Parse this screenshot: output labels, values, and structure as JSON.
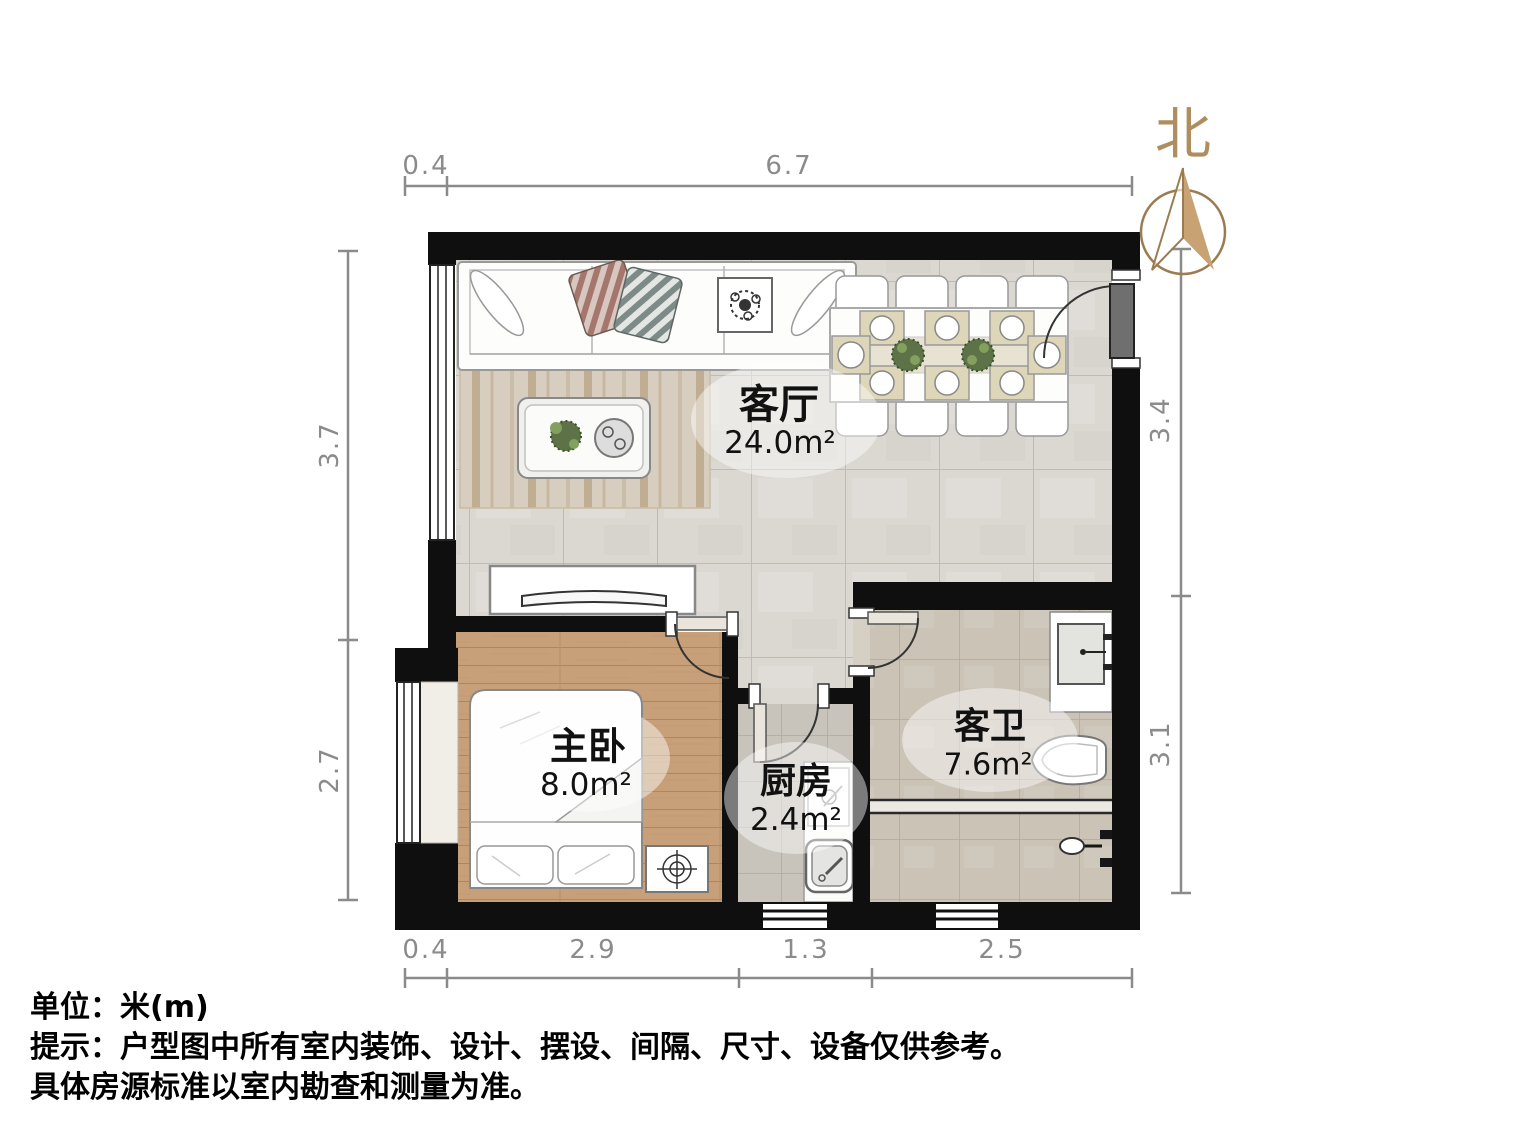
{
  "north": {
    "label": "北"
  },
  "rooms": {
    "living": {
      "name": "客厅",
      "area": "24.0m²"
    },
    "bedroom": {
      "name": "主卧",
      "area": "8.0m²"
    },
    "kitchen": {
      "name": "厨房",
      "area": "2.4m²"
    },
    "bathroom": {
      "name": "客卫",
      "area": "7.6m²"
    }
  },
  "dimensions": {
    "top": [
      "0.4",
      "6.7"
    ],
    "bottom": [
      "0.4",
      "2.9",
      "1.3",
      "2.5"
    ],
    "left": [
      "3.7",
      "2.7"
    ],
    "right": [
      "3.4",
      "3.1"
    ]
  },
  "footer": {
    "unit_line": "单位：米(m)",
    "note_line1": "提示：户型图中所有室内装饰、设计、摆设、间隔、尺寸、设备仅供参考。",
    "note_line2": "具体房源标准以室内勘查和测量为准。"
  },
  "icons": {
    "north_compass": "north-compass-arrow",
    "decor_plant": "flower"
  },
  "colors": {
    "compass_accent": "#c9a273",
    "dimension_gray": "#8b8b8b",
    "wall_black": "#0f0f0f",
    "wood_floor": "#c7a07a",
    "marble_tile": "#dbd8d2"
  }
}
